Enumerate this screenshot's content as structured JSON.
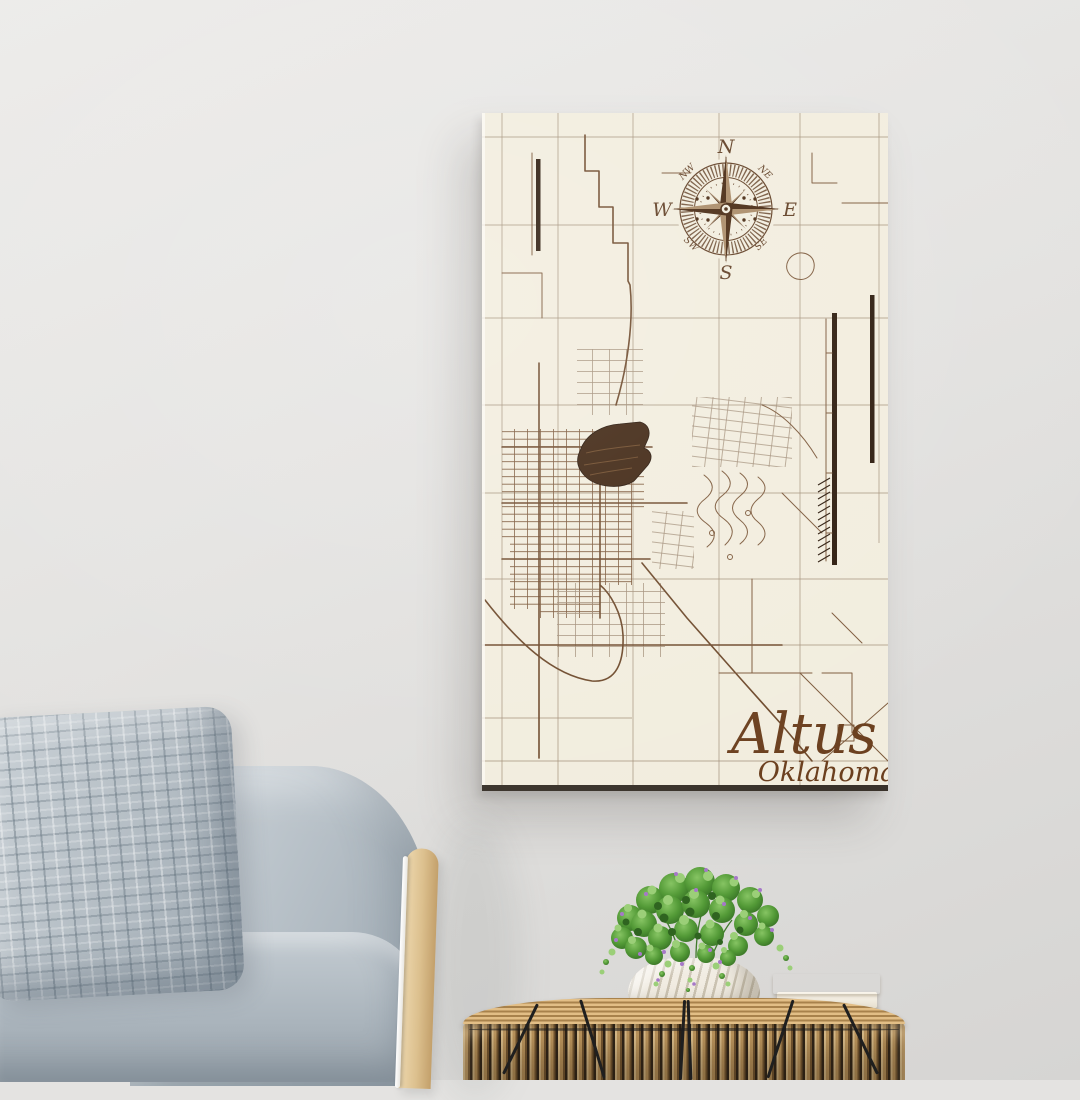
{
  "poster": {
    "title": "Altus",
    "subtitle": "Oklahoma",
    "compass": {
      "n": "N",
      "e": "E",
      "s": "S",
      "w": "W",
      "nw": "NW",
      "ne": "NE",
      "sw": "SW",
      "se": "SE"
    }
  },
  "palette": {
    "wallTop": "#ecebe9",
    "wallBottom": "#d6d5d3",
    "canvas": "#f2edde",
    "mapLine": "#7d5a3c",
    "mapMajor": "#6e4a2c",
    "mapLight": "#a3907a",
    "mapDark": "#2c1a0c",
    "lake": "#3f2511",
    "lakeGrain": "#6f4b2a",
    "compassInk": "#5f3d22",
    "compassDark": "#46270f",
    "compassLight": "#a98a66",
    "titleInk": "#6b3f1e",
    "panelEdge": "#39322a",
    "sofaFabric": "#b7c0c7",
    "knitFabric": "#b9c2c8",
    "wood": "#dcc08e",
    "rodWhite": "#ffffff",
    "rattan": "#cda268",
    "rattanDark": "#7a5a33",
    "cord": "#1f1f1f",
    "pot": "#f1ece2",
    "foliage": "#5fa847",
    "foliageDark": "#2f6420",
    "foliageLight": "#9bcf78",
    "flower": "#a678c8",
    "bookPink": "#e8536f",
    "bookPages": "#f6f2e9"
  }
}
